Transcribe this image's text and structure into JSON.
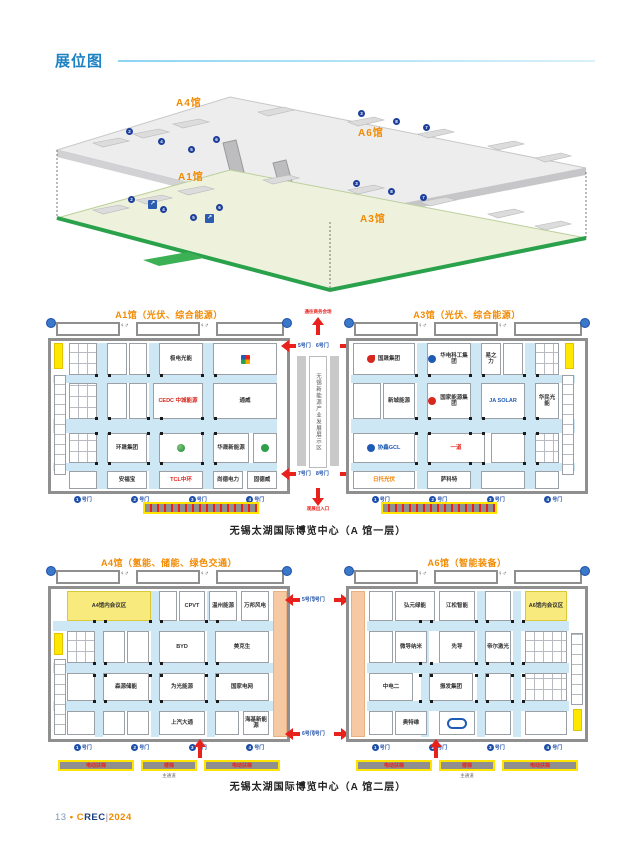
{
  "page": {
    "title": "展位图"
  },
  "icons": {
    "restroom": "♀♂",
    "escalator_arrow": "↗"
  },
  "overview": {
    "a4": "A4馆",
    "a6": "A6馆",
    "a1": "A1馆",
    "a3": "A3馆",
    "dots": [
      {
        "x": 78,
        "y": 40,
        "n": "2"
      },
      {
        "x": 110,
        "y": 50,
        "n": "4"
      },
      {
        "x": 140,
        "y": 58,
        "n": "5"
      },
      {
        "x": 165,
        "y": 48,
        "n": "6"
      },
      {
        "x": 310,
        "y": 22,
        "n": "3"
      },
      {
        "x": 345,
        "y": 30,
        "n": "8"
      },
      {
        "x": 375,
        "y": 36,
        "n": "7"
      },
      {
        "x": 80,
        "y": 108,
        "n": "2"
      },
      {
        "x": 112,
        "y": 118,
        "n": "4"
      },
      {
        "x": 142,
        "y": 126,
        "n": "5"
      },
      {
        "x": 168,
        "y": 116,
        "n": "6"
      },
      {
        "x": 305,
        "y": 92,
        "n": "3"
      },
      {
        "x": 340,
        "y": 100,
        "n": "8"
      },
      {
        "x": 372,
        "y": 106,
        "n": "7"
      }
    ]
  },
  "floor1": {
    "title_a1": "A1馆（光伏、综合能源）",
    "title_a3": "A3馆（光伏、综合能源）",
    "caption": "无锡太湖国际博览中心（A 馆一层）",
    "corridor": {
      "text": "无锡新能源产业发展展示区",
      "top_label": "通往商务会场",
      "bottom_label": "观展出入口",
      "tl": "5号门",
      "tr": "6号门",
      "bl": "7号门",
      "br": "8号门"
    },
    "a1": {
      "booths": [
        {
          "x": 3,
          "y": 2,
          "w": 9,
          "h": 26,
          "cls": "yellowblock"
        },
        {
          "x": 3,
          "y": 34,
          "w": 12,
          "h": 100,
          "cls": "clusterv"
        },
        {
          "x": 18,
          "y": 2,
          "w": 28,
          "h": 32,
          "cls": "cluster"
        },
        {
          "x": 56,
          "y": 2,
          "w": 20,
          "h": 32,
          "cls": "small"
        },
        {
          "x": 78,
          "y": 2,
          "w": 18,
          "h": 32,
          "cls": "small"
        },
        {
          "x": 108,
          "y": 2,
          "w": 44,
          "h": 32,
          "name": "极电光能"
        },
        {
          "x": 162,
          "y": 2,
          "w": 64,
          "h": 32,
          "logo": "pinwheel"
        },
        {
          "x": 18,
          "y": 42,
          "w": 28,
          "h": 36,
          "cls": "cluster"
        },
        {
          "x": 56,
          "y": 42,
          "w": 20,
          "h": 36,
          "cls": "small"
        },
        {
          "x": 78,
          "y": 42,
          "w": 18,
          "h": 36,
          "cls": "small"
        },
        {
          "x": 102,
          "y": 42,
          "w": 50,
          "h": 36,
          "name": "CEDC 中城能源",
          "c": "#d6281e"
        },
        {
          "x": 162,
          "y": 42,
          "w": 64,
          "h": 36,
          "name": "通威"
        },
        {
          "x": 18,
          "y": 92,
          "w": 28,
          "h": 30,
          "cls": "cluster"
        },
        {
          "x": 56,
          "y": 92,
          "w": 40,
          "h": 30,
          "name": "环晟集团"
        },
        {
          "x": 108,
          "y": 92,
          "w": 44,
          "h": 30,
          "logo": "globe"
        },
        {
          "x": 162,
          "y": 92,
          "w": 36,
          "h": 30,
          "name": "华晟新能源"
        },
        {
          "x": 202,
          "y": 92,
          "w": 24,
          "h": 30,
          "logo": "green"
        },
        {
          "x": 18,
          "y": 130,
          "w": 28,
          "h": 18,
          "cls": "small"
        },
        {
          "x": 56,
          "y": 130,
          "w": 40,
          "h": 18,
          "name": "安福宝"
        },
        {
          "x": 108,
          "y": 130,
          "w": 44,
          "h": 18,
          "name": "TCL中环",
          "c": "#e5231b"
        },
        {
          "x": 162,
          "y": 130,
          "w": 30,
          "h": 18,
          "name": "尚德电力"
        },
        {
          "x": 196,
          "y": 130,
          "w": 30,
          "h": 18,
          "name": "固德威"
        }
      ],
      "aisles": [
        {
          "x": 46,
          "y": 2,
          "w": 10,
          "h": 146
        },
        {
          "x": 98,
          "y": 2,
          "w": 10,
          "h": 146
        },
        {
          "x": 152,
          "y": 2,
          "w": 10,
          "h": 146
        },
        {
          "x": 2,
          "y": 34,
          "w": 224,
          "h": 8
        },
        {
          "x": 2,
          "y": 78,
          "w": 224,
          "h": 14
        },
        {
          "x": 2,
          "y": 122,
          "w": 224,
          "h": 8
        }
      ],
      "pillars": {
        "xs": [
          44,
          57,
          96,
          109,
          150,
          163
        ],
        "ys": [
          33,
          76,
          91,
          121
        ]
      },
      "gates": [
        {
          "n": "1",
          "t": "号门"
        },
        {
          "n": "2",
          "t": "号门"
        },
        {
          "n": "3",
          "t": "号门"
        },
        {
          "n": "4",
          "t": "号门"
        }
      ]
    },
    "a3": {
      "booths": [
        {
          "x": 216,
          "y": 2,
          "w": 9,
          "h": 26,
          "cls": "yellowblock"
        },
        {
          "x": 213,
          "y": 34,
          "w": 12,
          "h": 100,
          "cls": "clusterv"
        },
        {
          "x": 4,
          "y": 2,
          "w": 62,
          "h": 32,
          "name": "国晟集团",
          "logo": "flame"
        },
        {
          "x": 78,
          "y": 2,
          "w": 44,
          "h": 32,
          "name": "华电科工集团",
          "logo": "blue"
        },
        {
          "x": 132,
          "y": 2,
          "w": 20,
          "h": 32,
          "name": "易之力"
        },
        {
          "x": 154,
          "y": 2,
          "w": 20,
          "h": 32,
          "cls": "small"
        },
        {
          "x": 186,
          "y": 2,
          "w": 24,
          "h": 32,
          "cls": "cluster"
        },
        {
          "x": 4,
          "y": 42,
          "w": 28,
          "h": 36,
          "cls": "small"
        },
        {
          "x": 34,
          "y": 42,
          "w": 32,
          "h": 36,
          "name": "新城能源"
        },
        {
          "x": 78,
          "y": 42,
          "w": 44,
          "h": 36,
          "name": "国家能源集团",
          "logo": "red"
        },
        {
          "x": 132,
          "y": 42,
          "w": 44,
          "h": 36,
          "name": "JA SOLAR",
          "c": "#1f5bb5"
        },
        {
          "x": 186,
          "y": 42,
          "w": 24,
          "h": 36,
          "name": "华民光能"
        },
        {
          "x": 4,
          "y": 92,
          "w": 62,
          "h": 30,
          "name": "协鑫GCL",
          "c": "#1f5bb5",
          "logo": "blue"
        },
        {
          "x": 78,
          "y": 92,
          "w": 58,
          "h": 30,
          "name": "一道",
          "c": "#e5231b"
        },
        {
          "x": 142,
          "y": 92,
          "w": 34,
          "h": 30,
          "cls": "small"
        },
        {
          "x": 186,
          "y": 92,
          "w": 24,
          "h": 30,
          "cls": "cluster"
        },
        {
          "x": 4,
          "y": 130,
          "w": 62,
          "h": 18,
          "name": "日托光伏",
          "c": "#f08300"
        },
        {
          "x": 78,
          "y": 130,
          "w": 44,
          "h": 18,
          "name": "萨科特"
        },
        {
          "x": 132,
          "y": 130,
          "w": 44,
          "h": 18,
          "cls": "small"
        },
        {
          "x": 186,
          "y": 130,
          "w": 24,
          "h": 18,
          "cls": "small"
        }
      ],
      "aisles": [
        {
          "x": 68,
          "y": 2,
          "w": 10,
          "h": 146
        },
        {
          "x": 122,
          "y": 2,
          "w": 10,
          "h": 146
        },
        {
          "x": 176,
          "y": 2,
          "w": 10,
          "h": 146
        },
        {
          "x": 2,
          "y": 34,
          "w": 224,
          "h": 8
        },
        {
          "x": 2,
          "y": 78,
          "w": 224,
          "h": 14
        },
        {
          "x": 2,
          "y": 122,
          "w": 224,
          "h": 8
        }
      ],
      "pillars": {
        "xs": [
          66,
          79,
          120,
          133,
          174,
          187
        ],
        "ys": [
          33,
          76,
          91,
          121
        ]
      },
      "gates": [
        {
          "n": "1",
          "t": "号门"
        },
        {
          "n": "2",
          "t": "号门"
        },
        {
          "n": "3",
          "t": "号门"
        },
        {
          "n": "4",
          "t": "号门"
        }
      ]
    }
  },
  "floor2": {
    "title_a4": "A4馆（氢能、储能、绿色交通）",
    "title_a6": "A6馆（智能装备）",
    "caption": "无锡太湖国际博览中心（A 馆二层）",
    "main_aisle": "主通道",
    "side": {
      "a4_top": "5号门",
      "a4_bottom": "6号门",
      "a6_top": "5号门",
      "a6_bottom": "6号门"
    },
    "bars": [
      {
        "t": "电动扶梯"
      },
      {
        "t": "楼梯"
      },
      {
        "t": "电动扶梯"
      }
    ],
    "a4": {
      "booths": [
        {
          "x": 3,
          "y": 44,
          "w": 9,
          "h": 22,
          "cls": "yellowblock"
        },
        {
          "x": 3,
          "y": 70,
          "w": 12,
          "h": 76,
          "cls": "clusterv"
        },
        {
          "x": 222,
          "y": 2,
          "w": 14,
          "h": 146,
          "cls": "peach"
        },
        {
          "x": 16,
          "y": 2,
          "w": 84,
          "h": 30,
          "cls": "yellow",
          "name": "A4馆内会议区"
        },
        {
          "x": 108,
          "y": 2,
          "w": 18,
          "h": 30,
          "cls": "small"
        },
        {
          "x": 128,
          "y": 2,
          "w": 26,
          "h": 30,
          "name": "CPVT"
        },
        {
          "x": 158,
          "y": 2,
          "w": 28,
          "h": 30,
          "name": "温州能源"
        },
        {
          "x": 190,
          "y": 2,
          "w": 28,
          "h": 30,
          "name": "万邦风电"
        },
        {
          "x": 16,
          "y": 42,
          "w": 28,
          "h": 32,
          "cls": "cluster"
        },
        {
          "x": 52,
          "y": 42,
          "w": 22,
          "h": 32,
          "cls": "small"
        },
        {
          "x": 76,
          "y": 42,
          "w": 22,
          "h": 32,
          "cls": "small"
        },
        {
          "x": 108,
          "y": 42,
          "w": 46,
          "h": 32,
          "name": "BYD"
        },
        {
          "x": 164,
          "y": 42,
          "w": 54,
          "h": 32,
          "name": "美克生"
        },
        {
          "x": 16,
          "y": 84,
          "w": 28,
          "h": 28,
          "cls": "small"
        },
        {
          "x": 52,
          "y": 84,
          "w": 46,
          "h": 28,
          "name": "森源储能"
        },
        {
          "x": 108,
          "y": 84,
          "w": 46,
          "h": 28,
          "name": "为光能源"
        },
        {
          "x": 164,
          "y": 84,
          "w": 54,
          "h": 28,
          "name": "国家电网"
        },
        {
          "x": 16,
          "y": 122,
          "w": 28,
          "h": 24,
          "cls": "small"
        },
        {
          "x": 52,
          "y": 122,
          "w": 22,
          "h": 24,
          "cls": "small"
        },
        {
          "x": 76,
          "y": 122,
          "w": 22,
          "h": 24,
          "cls": "small"
        },
        {
          "x": 108,
          "y": 122,
          "w": 46,
          "h": 24,
          "name": "上汽大通"
        },
        {
          "x": 164,
          "y": 122,
          "w": 24,
          "h": 24,
          "cls": "small"
        },
        {
          "x": 192,
          "y": 122,
          "w": 26,
          "h": 24,
          "name": "海基新能源"
        }
      ],
      "aisles": [
        {
          "x": 44,
          "y": 2,
          "w": 8,
          "h": 146
        },
        {
          "x": 100,
          "y": 2,
          "w": 8,
          "h": 146
        },
        {
          "x": 156,
          "y": 2,
          "w": 8,
          "h": 146
        },
        {
          "x": 2,
          "y": 32,
          "w": 220,
          "h": 10
        },
        {
          "x": 2,
          "y": 74,
          "w": 220,
          "h": 10
        },
        {
          "x": 2,
          "y": 112,
          "w": 220,
          "h": 10
        }
      ],
      "pillars": {
        "xs": [
          42,
          53,
          98,
          109,
          154,
          165
        ],
        "ys": [
          31,
          73,
          85,
          111
        ]
      },
      "gates": [
        {
          "n": "1",
          "t": "号门"
        },
        {
          "n": "2",
          "t": "号门"
        },
        {
          "n": "3",
          "t": "号门"
        },
        {
          "n": "4",
          "t": "号门"
        }
      ]
    },
    "a6": {
      "booths": [
        {
          "x": 2,
          "y": 2,
          "w": 14,
          "h": 146,
          "cls": "peach"
        },
        {
          "x": 222,
          "y": 44,
          "w": 12,
          "h": 72,
          "cls": "clusterv"
        },
        {
          "x": 224,
          "y": 120,
          "w": 9,
          "h": 22,
          "cls": "yellowblock"
        },
        {
          "x": 20,
          "y": 2,
          "w": 24,
          "h": 30,
          "cls": "small"
        },
        {
          "x": 46,
          "y": 2,
          "w": 40,
          "h": 30,
          "name": "弘元绿能"
        },
        {
          "x": 90,
          "y": 2,
          "w": 36,
          "h": 30,
          "name": "江松智能"
        },
        {
          "x": 136,
          "y": 2,
          "w": 26,
          "h": 30,
          "cls": "small"
        },
        {
          "x": 176,
          "y": 2,
          "w": 42,
          "h": 30,
          "cls": "yellow",
          "name": "A6馆内会议区"
        },
        {
          "x": 20,
          "y": 42,
          "w": 24,
          "h": 32,
          "cls": "small"
        },
        {
          "x": 46,
          "y": 42,
          "w": 32,
          "h": 32,
          "name": "微导纳米"
        },
        {
          "x": 90,
          "y": 42,
          "w": 36,
          "h": 32,
          "name": "先导"
        },
        {
          "x": 136,
          "y": 42,
          "w": 26,
          "h": 32,
          "name": "帝尔激光"
        },
        {
          "x": 176,
          "y": 42,
          "w": 42,
          "h": 32,
          "cls": "cluster"
        },
        {
          "x": 20,
          "y": 84,
          "w": 44,
          "h": 28,
          "name": "中电二"
        },
        {
          "x": 80,
          "y": 84,
          "w": 44,
          "h": 28,
          "name": "振发集团"
        },
        {
          "x": 136,
          "y": 84,
          "w": 26,
          "h": 28,
          "cls": "small"
        },
        {
          "x": 176,
          "y": 84,
          "w": 42,
          "h": 28,
          "cls": "cluster"
        },
        {
          "x": 20,
          "y": 122,
          "w": 24,
          "h": 24,
          "cls": "small"
        },
        {
          "x": 46,
          "y": 122,
          "w": 32,
          "h": 24,
          "name": "奥特维"
        },
        {
          "x": 90,
          "y": 122,
          "w": 36,
          "h": 24,
          "logo": "oval"
        },
        {
          "x": 136,
          "y": 122,
          "w": 26,
          "h": 24,
          "cls": "small"
        },
        {
          "x": 176,
          "y": 122,
          "w": 42,
          "h": 24,
          "cls": "small"
        }
      ],
      "aisles": [
        {
          "x": 72,
          "y": 2,
          "w": 8,
          "h": 146
        },
        {
          "x": 128,
          "y": 2,
          "w": 8,
          "h": 146
        },
        {
          "x": 164,
          "y": 2,
          "w": 8,
          "h": 146
        },
        {
          "x": 18,
          "y": 32,
          "w": 202,
          "h": 10
        },
        {
          "x": 18,
          "y": 74,
          "w": 202,
          "h": 10
        },
        {
          "x": 18,
          "y": 112,
          "w": 202,
          "h": 10
        }
      ],
      "pillars": {
        "xs": [
          70,
          81,
          126,
          137,
          162,
          173
        ],
        "ys": [
          31,
          73,
          85,
          111
        ]
      },
      "gates": [
        {
          "n": "1",
          "t": "号门"
        },
        {
          "n": "2",
          "t": "号门"
        },
        {
          "n": "3",
          "t": "号门"
        },
        {
          "n": "4",
          "t": "号门"
        }
      ]
    }
  },
  "footer": {
    "page_no": "13",
    "dot": "•",
    "brand_c": "C",
    "brand_rest": "REC",
    "divider": "|",
    "year": "2024"
  }
}
